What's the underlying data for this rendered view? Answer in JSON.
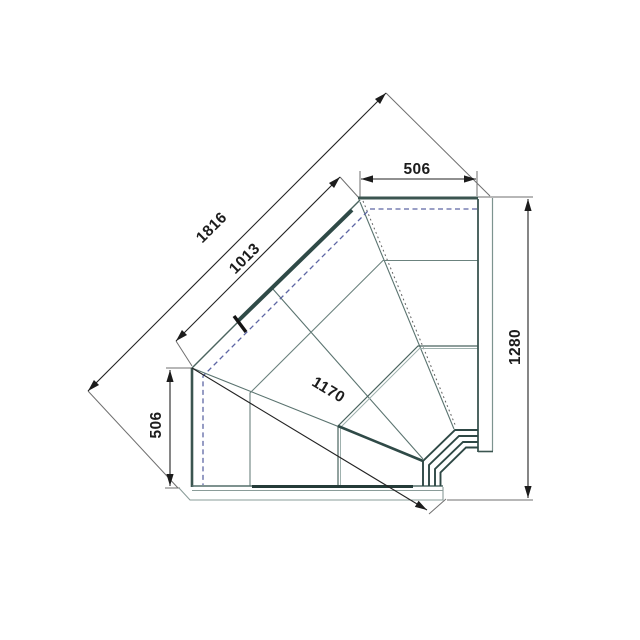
{
  "drawing": {
    "title": "corner-counter-plan-view",
    "dimensions": {
      "top_width": {
        "value": "506",
        "unit_hint": "mm",
        "orientation": "horizontal"
      },
      "outer_diagonal": {
        "value": "1816",
        "unit_hint": "mm",
        "orientation": "diagonal-45"
      },
      "inner_diagonal": {
        "value": "1013",
        "unit_hint": "mm",
        "orientation": "diagonal-45"
      },
      "front_diagonal": {
        "value": "1170",
        "unit_hint": "mm",
        "orientation": "diagonal-31"
      },
      "left_depth": {
        "value": "506",
        "unit_hint": "mm",
        "orientation": "vertical"
      },
      "side_depth": {
        "value": "1280",
        "unit_hint": "mm",
        "orientation": "vertical"
      }
    },
    "colors": {
      "line_dark": "#2f4a47",
      "line_mid": "#4a645f",
      "line_light": "#8a9c99",
      "dim_black": "#222222",
      "dashed_blue": "#5d66a4",
      "background": "#ffffff"
    }
  }
}
